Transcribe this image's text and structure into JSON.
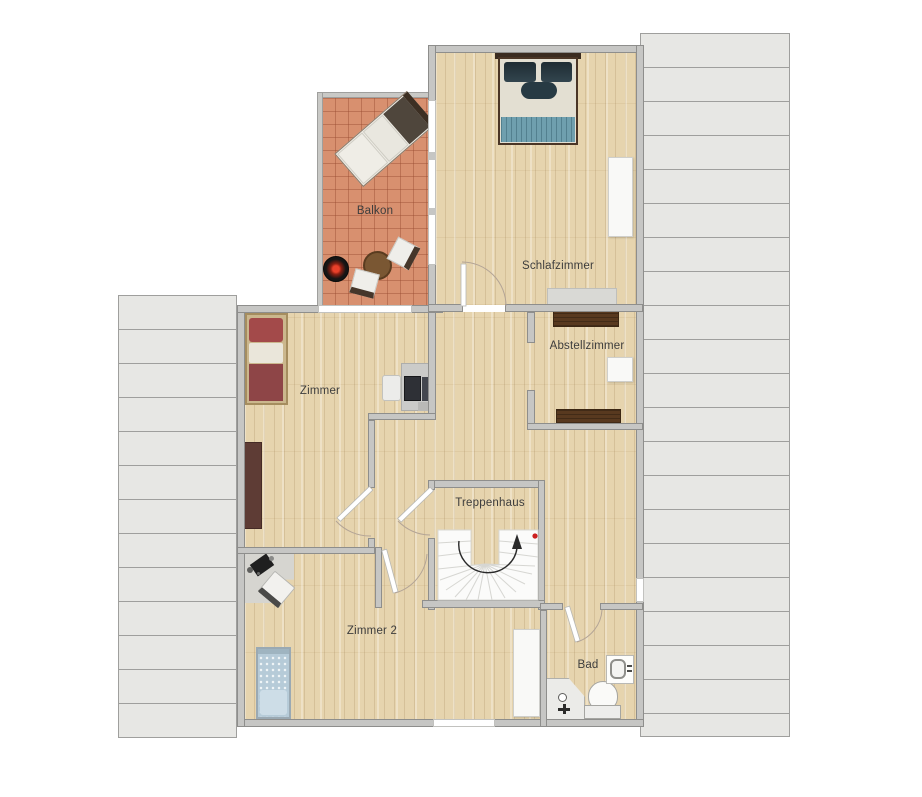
{
  "floorplan": {
    "title": "Obergeschoss Grundriss",
    "rooms": [
      {
        "id": "balkon",
        "label": "Balkon"
      },
      {
        "id": "schlafzimmer",
        "label": "Schlafzimmer"
      },
      {
        "id": "abstellzimmer",
        "label": "Abstellzimmer"
      },
      {
        "id": "zimmer",
        "label": "Zimmer"
      },
      {
        "id": "treppenhaus",
        "label": "Treppenhaus"
      },
      {
        "id": "zimmer2",
        "label": "Zimmer 2"
      },
      {
        "id": "bad",
        "label": "Bad"
      }
    ],
    "furniture": [
      "double-bed",
      "wardrobe",
      "sideboard",
      "storage-shelf",
      "storage-box",
      "single-bed-red",
      "desk-with-monitor",
      "desk-chair",
      "corner-desk",
      "laptop",
      "single-bed-blue",
      "white-wardrobe",
      "sink",
      "toilet",
      "shower",
      "sun-lounger",
      "round-table",
      "patio-chair",
      "fire-bowl",
      "spiral-stairs",
      "direction-arrow"
    ],
    "colors": {
      "background": "#ffffff",
      "wall": "#c6c6c4",
      "wall_outline": "#8e8e8c",
      "roof_panel": "#e7e7e4",
      "roof_line": "#9f9f9d",
      "wood_floor": "#e6d4ae",
      "balcony_tile": "#d8906f",
      "stair_white": "#fbfbfa",
      "blanket_blue": "#6f9fae",
      "bed_red": "#8e4547",
      "bed_blue": "#b6cbd8",
      "shelf_brown": "#58391f",
      "marker_red": "#cc1f1f"
    }
  }
}
